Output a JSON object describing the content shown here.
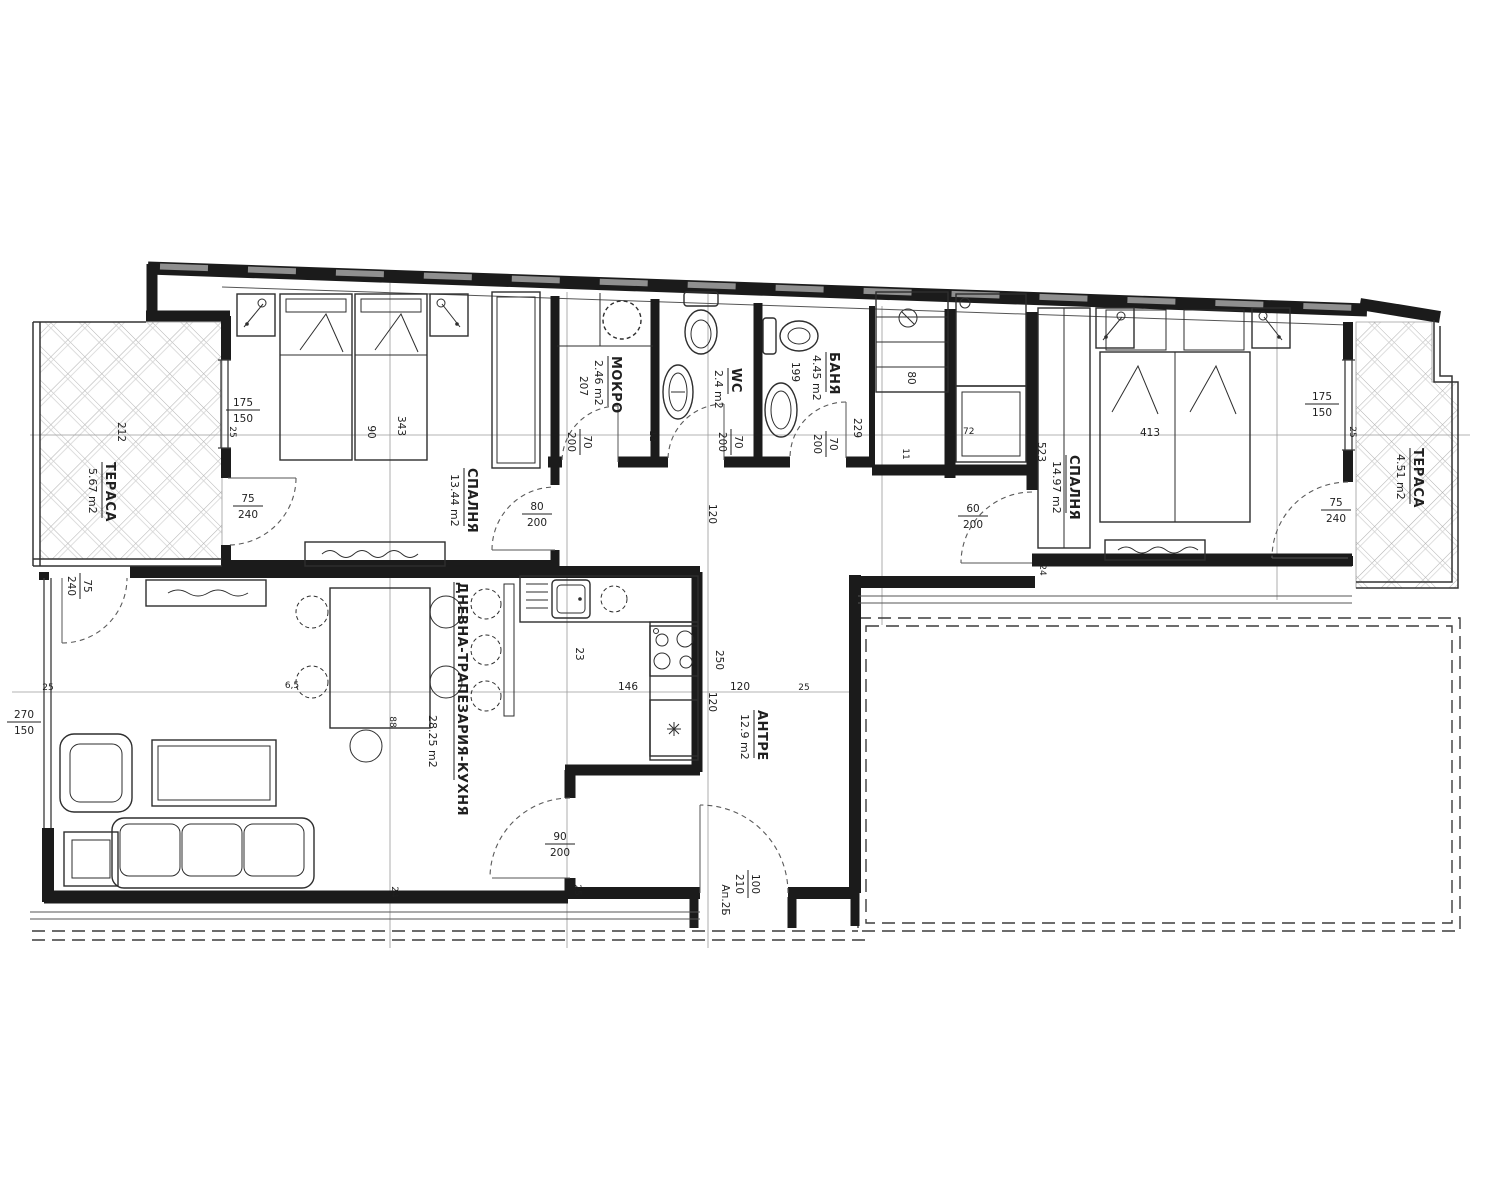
{
  "plan": {
    "rooms": {
      "terrace_left": {
        "name": "ТЕРАСА",
        "area": "5.67 m2"
      },
      "bedroom1": {
        "name": "СПАЛНЯ",
        "area": "13.44 m2"
      },
      "laundry": {
        "name": "МОКРО",
        "area": "2.46 m2"
      },
      "wc": {
        "name": "WC",
        "area": "2.4 m2"
      },
      "bathroom": {
        "name": "БАНЯ",
        "area": "4.45 m2"
      },
      "bedroom2": {
        "name": "СПАЛНЯ",
        "area": "14.97 m2"
      },
      "terrace_right": {
        "name": "ТЕРАСА",
        "area": "4.51 m2"
      },
      "living": {
        "name": "ДНЕВНА-ТРАПЕЗАРИЯ-КУХНЯ",
        "area": "28.25 m2"
      },
      "hall": {
        "name": "АНТРЕ",
        "area": "12.9 m2"
      }
    },
    "openings": {
      "win_terrace_left": {
        "w": "175",
        "h": "150"
      },
      "door_bed1_terrace": {
        "w": "75",
        "h": "240"
      },
      "door_living_terrace": {
        "w": "75",
        "h": "240"
      },
      "win_living_left": {
        "w": "270",
        "h": "150"
      },
      "door_bed1": {
        "w": "80",
        "h": "200"
      },
      "door_laundry": {
        "w": "70",
        "h": "200"
      },
      "door_wc": {
        "w": "70",
        "h": "200"
      },
      "door_bath": {
        "w": "70",
        "h": "200"
      },
      "door_bed2": {
        "w": "60",
        "h": "200"
      },
      "door_kitchen": {
        "w": "90",
        "h": "200"
      },
      "door_entry": {
        "apt": "Ап.2Б",
        "w": "100",
        "h": "210"
      },
      "win_terrace_right": {
        "w": "175",
        "h": "150"
      },
      "door_bed2_terrace": {
        "w": "75",
        "h": "240"
      }
    },
    "dims": {
      "terrace_l_w": "212",
      "bed_w": "90",
      "bed_l": "343",
      "laundry_d": "207",
      "bath_d": "199",
      "bath_w": "229",
      "shelf_w": "80",
      "pass_w": "72",
      "wall11": "11",
      "wall12": "12",
      "wall24": "24",
      "wall25": "25",
      "corridor_w": "120",
      "hall_len": "250",
      "counter_w": "146",
      "counter_d": "23",
      "bed2_w": "413",
      "bed2_d": "523",
      "table_d": "6,5",
      "chair_d": "88"
    }
  }
}
